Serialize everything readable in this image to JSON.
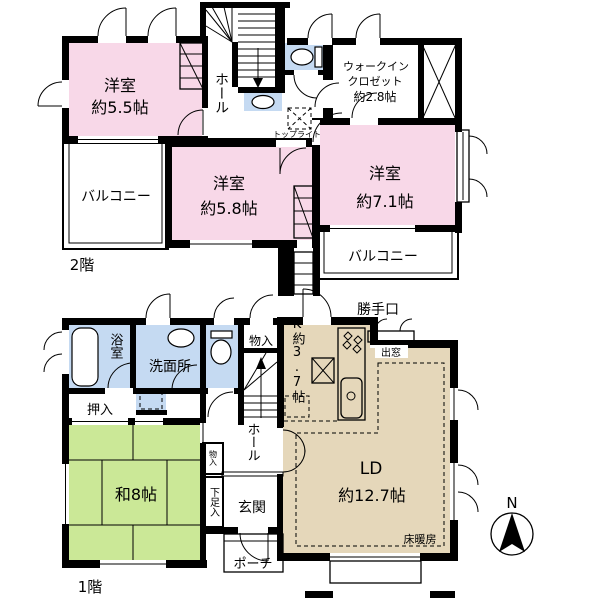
{
  "title": "間取り図",
  "colors": {
    "wall": "#000000",
    "room_pink": "#F8D8E8",
    "water_blue": "#C5DAF2",
    "tatami_green": "#CBE897",
    "wood_tan": "#E5D7BA",
    "background": "#FFFFFF"
  },
  "f2": {
    "floor": "2階",
    "b55": {
      "name": "洋室",
      "size": "約5.5帖"
    },
    "b58": {
      "name": "洋室",
      "size": "約5.8帖"
    },
    "b71": {
      "name": "洋室",
      "size": "約7.1帖"
    },
    "wic": {
      "l1": "ウォークイン",
      "l2": "クロゼット",
      "size": "約2.8帖"
    },
    "hall": "ホール",
    "balcony_l": "バルコニー",
    "balcony_r": "バルコニー",
    "skylight": "トップライト"
  },
  "f1": {
    "floor": "1階",
    "bath": "浴室",
    "wash": "洗面所",
    "storage": "物入",
    "kitchen": "K約3.7帖",
    "backdoor": "勝手口",
    "baywindow": "出窓",
    "oshiire": "押入",
    "washitsu": "和8帖",
    "storage2": "物入",
    "hall": "ホール",
    "shoes": "下足入",
    "entrance": "玄関",
    "porch": "ポーチ",
    "ld_name": "LD",
    "ld_size": "約12.7帖",
    "heating": "床暖房"
  },
  "compass": {
    "north": "N"
  }
}
